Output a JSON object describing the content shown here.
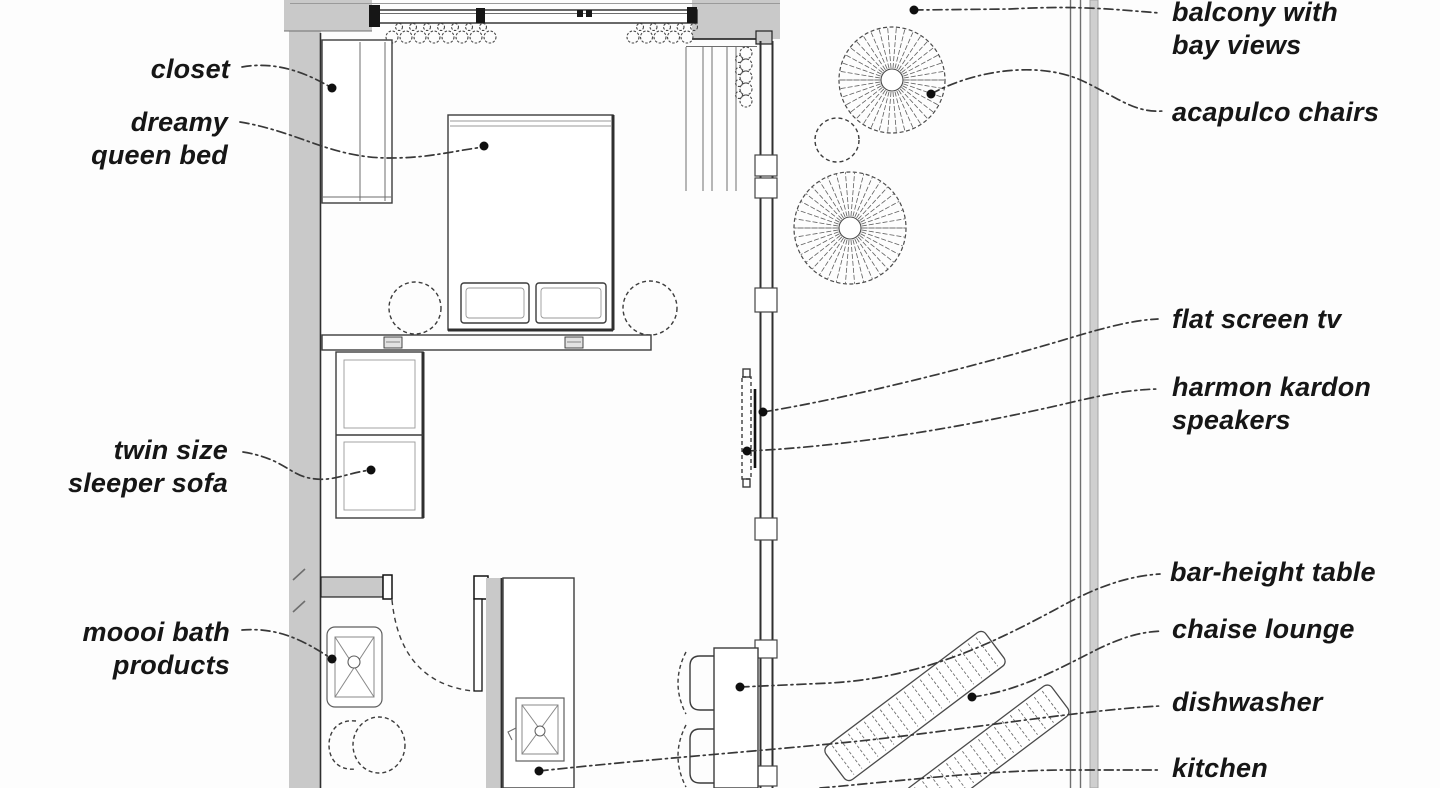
{
  "page": {
    "type": "hotel-room floor plan with annotations"
  },
  "colors": {
    "wall_fill": "#c9c9c9",
    "line_dark": "#2f2f2f",
    "label_text": "#161616",
    "background": "#fdfdfd"
  },
  "annotations": {
    "closet": {
      "label": "closet"
    },
    "queen_bed": {
      "line1": "dreamy",
      "line2": "queen bed"
    },
    "sleeper_sofa": {
      "line1": "twin size",
      "line2": "sleeper sofa"
    },
    "bath_products": {
      "line1": "moooi bath",
      "line2": "products"
    },
    "balcony": {
      "line1": "balcony with",
      "line2": "bay views"
    },
    "acapulco_chairs": {
      "label": "acapulco chairs"
    },
    "flat_screen_tv": {
      "label": "flat screen tv"
    },
    "speakers": {
      "line1": "harmon kardon",
      "line2": "speakers"
    },
    "bar_table": {
      "label": "bar-height table"
    },
    "chaise_lounge": {
      "label": "chaise lounge"
    },
    "dishwasher": {
      "label": "dishwasher"
    },
    "kitchen": {
      "label": "kitchen"
    }
  }
}
